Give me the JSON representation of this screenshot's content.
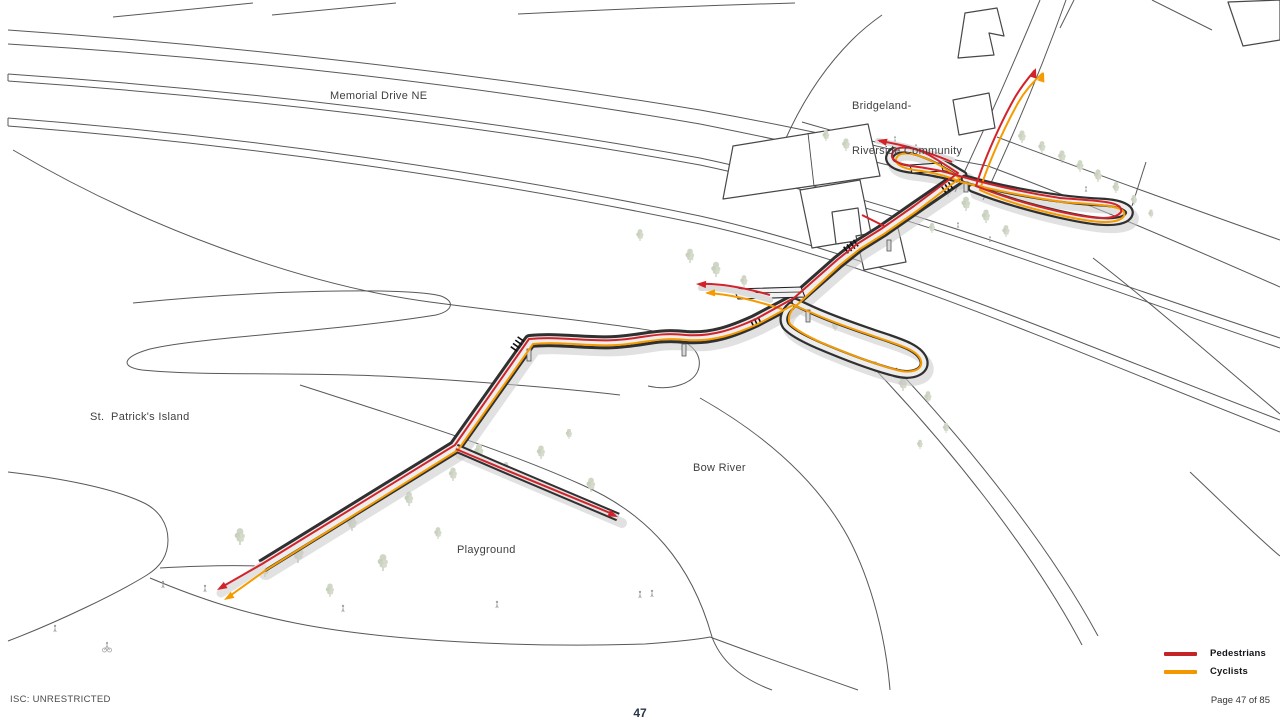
{
  "page": {
    "footer_left": "ISC: UNRESTRICTED",
    "footer_right": "Page 47 of 85",
    "page_number": "47"
  },
  "map": {
    "labels": {
      "memorial_drive": "Memorial Drive NE",
      "bridgeland_line1": "Bridgeland-",
      "bridgeland_line2": "Riverside Community",
      "st_patricks_island": "St.  Patrick's Island",
      "bow_river": "Bow River",
      "playground": "Playground"
    },
    "legend": {
      "items": [
        {
          "label": "Pedestrians",
          "color": "#c42328"
        },
        {
          "label": "Cyclists",
          "color": "#f49600"
        }
      ]
    },
    "colors": {
      "pedestrian_route": "#d2232a",
      "cyclist_route": "#f59b00",
      "bridge_deck_dark": "#303030",
      "bridge_deck_light": "#ededed",
      "contour_line": "#58585a",
      "tree_green": "#ccd4c2"
    }
  }
}
